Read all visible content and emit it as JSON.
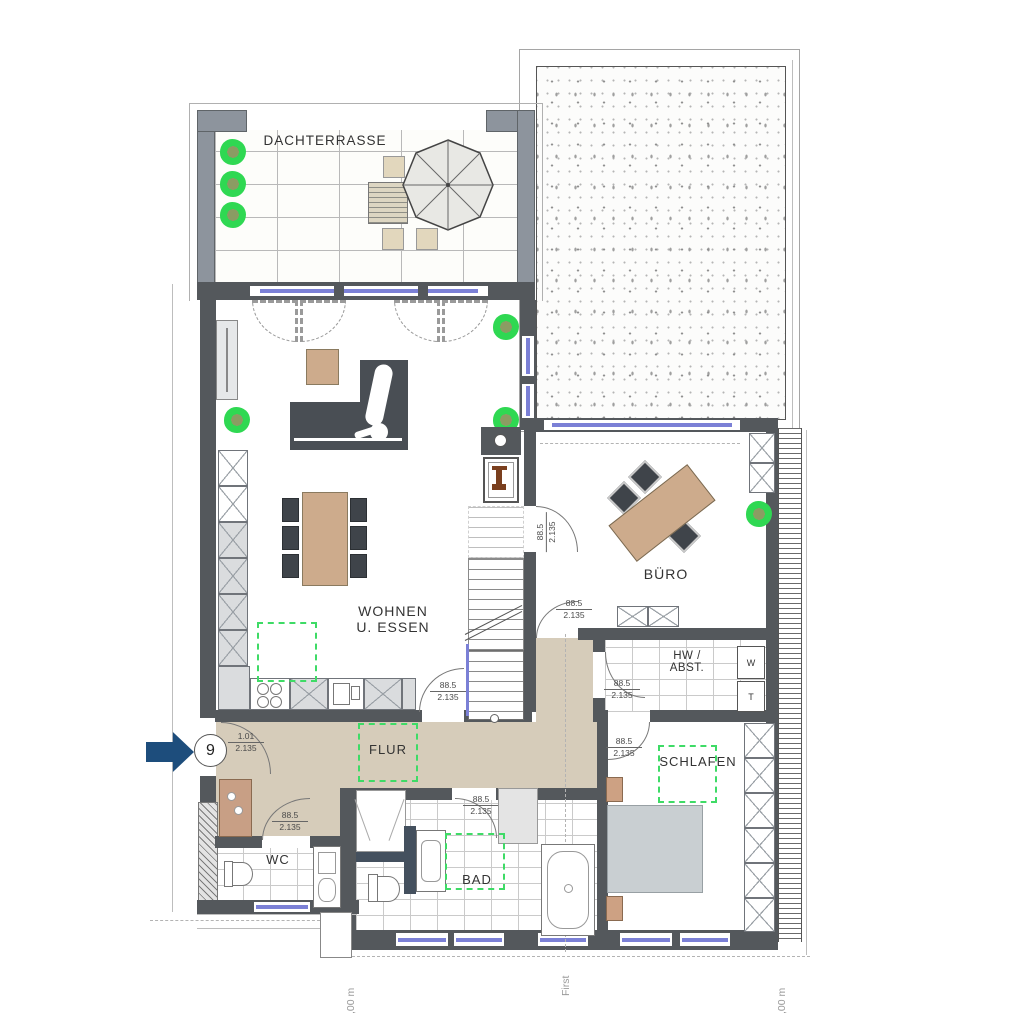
{
  "rooms": {
    "dachterrasse": {
      "label": "DACHTERRASSE"
    },
    "wohnen": {
      "line1": "WOHNEN",
      "line2": "U. ESSEN"
    },
    "buero": {
      "label": "BÜRO"
    },
    "hw_abst": {
      "line1": "HW /",
      "line2": "ABST."
    },
    "flur": {
      "label": "FLUR"
    },
    "wc": {
      "label": "WC"
    },
    "bad": {
      "label": "BAD"
    },
    "schlafen": {
      "label": "SCHLAFEN"
    }
  },
  "doors": {
    "standard": {
      "width": "88.5",
      "height": "2.135"
    },
    "entrance": {
      "width": "1.01",
      "height": "2.135"
    }
  },
  "entrance": {
    "unit_number": "9"
  },
  "appliances": {
    "washer": "W",
    "dryer": "T"
  },
  "section_labels": {
    "left": ",00 m",
    "center": "First",
    "right": ",00 m"
  },
  "colors": {
    "wall": "#54585c",
    "terrace_wall": "#8d949d",
    "hall_floor": "#d6ccba",
    "glazing": "#7b80d6",
    "planning_overlay_green": "#3edb66",
    "entrance_arrow_blue": "#1d4d7c",
    "furniture_wood": "#cdab8c",
    "sofa_gray": "#494e54",
    "bed_gray": "#c9cfd2"
  }
}
